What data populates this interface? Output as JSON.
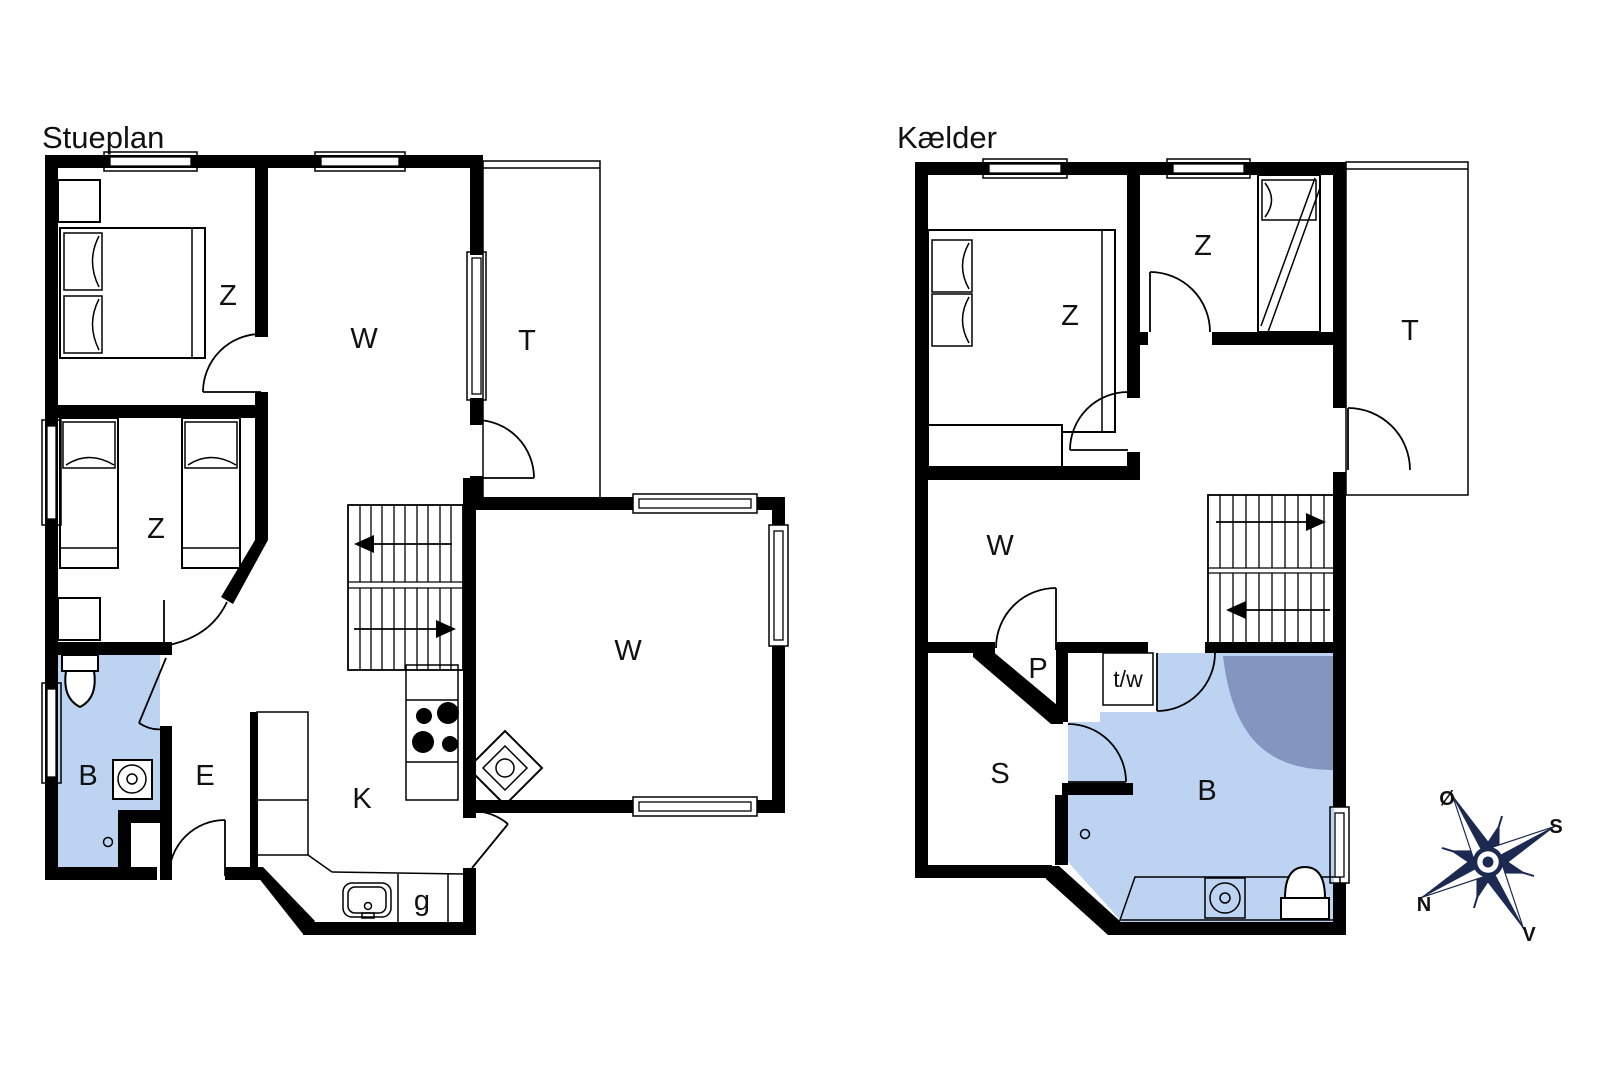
{
  "plans": [
    {
      "title": "Stueplan",
      "rooms": {
        "bedroom1": "Z",
        "bedroom2": "Z",
        "living_upper": "W",
        "terrace": "T",
        "bathroom": "B",
        "entrance": "E",
        "kitchen": "K",
        "utility": "g",
        "living_lower": "W"
      }
    },
    {
      "title": "Kælder",
      "rooms": {
        "bedroom1": "Z",
        "bedroom2": "Z",
        "terrace": "T",
        "living": "W",
        "hall": "P",
        "laundry": "t/w",
        "storage": "S",
        "bathroom": "B"
      }
    }
  ],
  "compass": {
    "east": "Ø",
    "south": "S",
    "north": "N",
    "west": "V"
  },
  "colors": {
    "wall": "#000000",
    "bathroom_fill": "#bdd3f2",
    "shower_fill": "#8496bf",
    "shower_stroke": "#3d4e78",
    "compass_navy": "#1c2950",
    "background": "#ffffff"
  }
}
